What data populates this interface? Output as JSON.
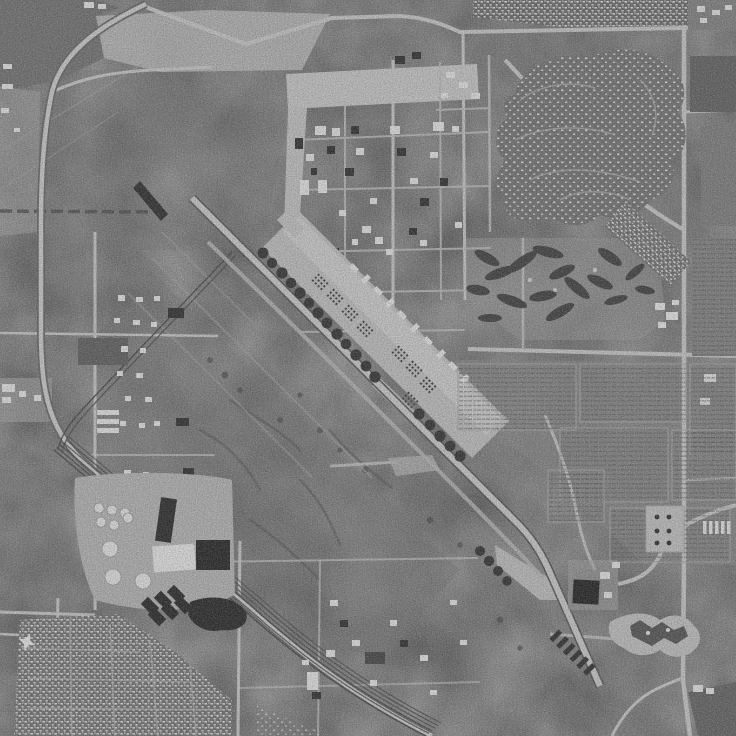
{
  "meta": {
    "title": "Grayscale aerial orthophoto of an air force base",
    "description": "Black-and-white USGS-style aerial photograph. A long NW-SE runway with a wide parking apron crosses the center; a street-grid cantonment with hangars sits top center; curving-street housing subdivisions upper right; a golf course with dark tree clusters center right; row-crop fields on the right; a curving freeway and railroad yard on the left; a tank farm with circular tanks and dark settling ponds lower left; dense housing bottom left; a small terminal pad bottom right."
  },
  "palette": {
    "terrain": "#8c8c8c",
    "terrain_dark": "#757575",
    "pavement": "#c6c6c6",
    "pavement_bright": "#d9d9d9",
    "road_light": "#cfcfcf",
    "road_casing": "#5f5f5f",
    "rail_dark": "#3b3b3b",
    "building_white": "#f1f1f1",
    "building_dark": "#1f1f1f",
    "revetment_dark": "#242424",
    "tree_dark": "#333333",
    "water_dark": "#171717",
    "housing_ground": "#6d6d6d",
    "field_ground": "#868686",
    "golf_ground": "#9b9b9b"
  },
  "scene": {
    "airfield": {
      "runway_orientation": "northwest-southeast diagonal",
      "revetment_rows": {
        "northwest_row": 13,
        "mid_row": 5,
        "threshold_row": 4
      },
      "threshold_chevrons": 7,
      "aircraft_formations": 8,
      "parked_large_aircraft": 10
    },
    "rail_yard_tracks": 6,
    "tank_farm": {
      "small_tanks": 6,
      "large_tanks": 3
    },
    "settling_ponds": {
      "small_basins": 6,
      "large_pond": 1
    },
    "regions": [
      {
        "name": "cantonment-grid",
        "location": "top center"
      },
      {
        "name": "housing-subdivision-curved",
        "location": "upper right"
      },
      {
        "name": "trailer-park-strip",
        "location": "top edge right"
      },
      {
        "name": "golf-course",
        "location": "center right"
      },
      {
        "name": "row-crop-fields",
        "location": "right middle"
      },
      {
        "name": "freeway-corridor",
        "location": "left edge"
      },
      {
        "name": "railroad-yard",
        "location": "lower left diagonal"
      },
      {
        "name": "industrial-lots",
        "location": "left middle"
      },
      {
        "name": "tank-farm",
        "location": "lower left"
      },
      {
        "name": "dense-housing",
        "location": "bottom left"
      },
      {
        "name": "terminal-pad",
        "location": "bottom right"
      },
      {
        "name": "desert-scrub",
        "location": "center"
      }
    ]
  }
}
